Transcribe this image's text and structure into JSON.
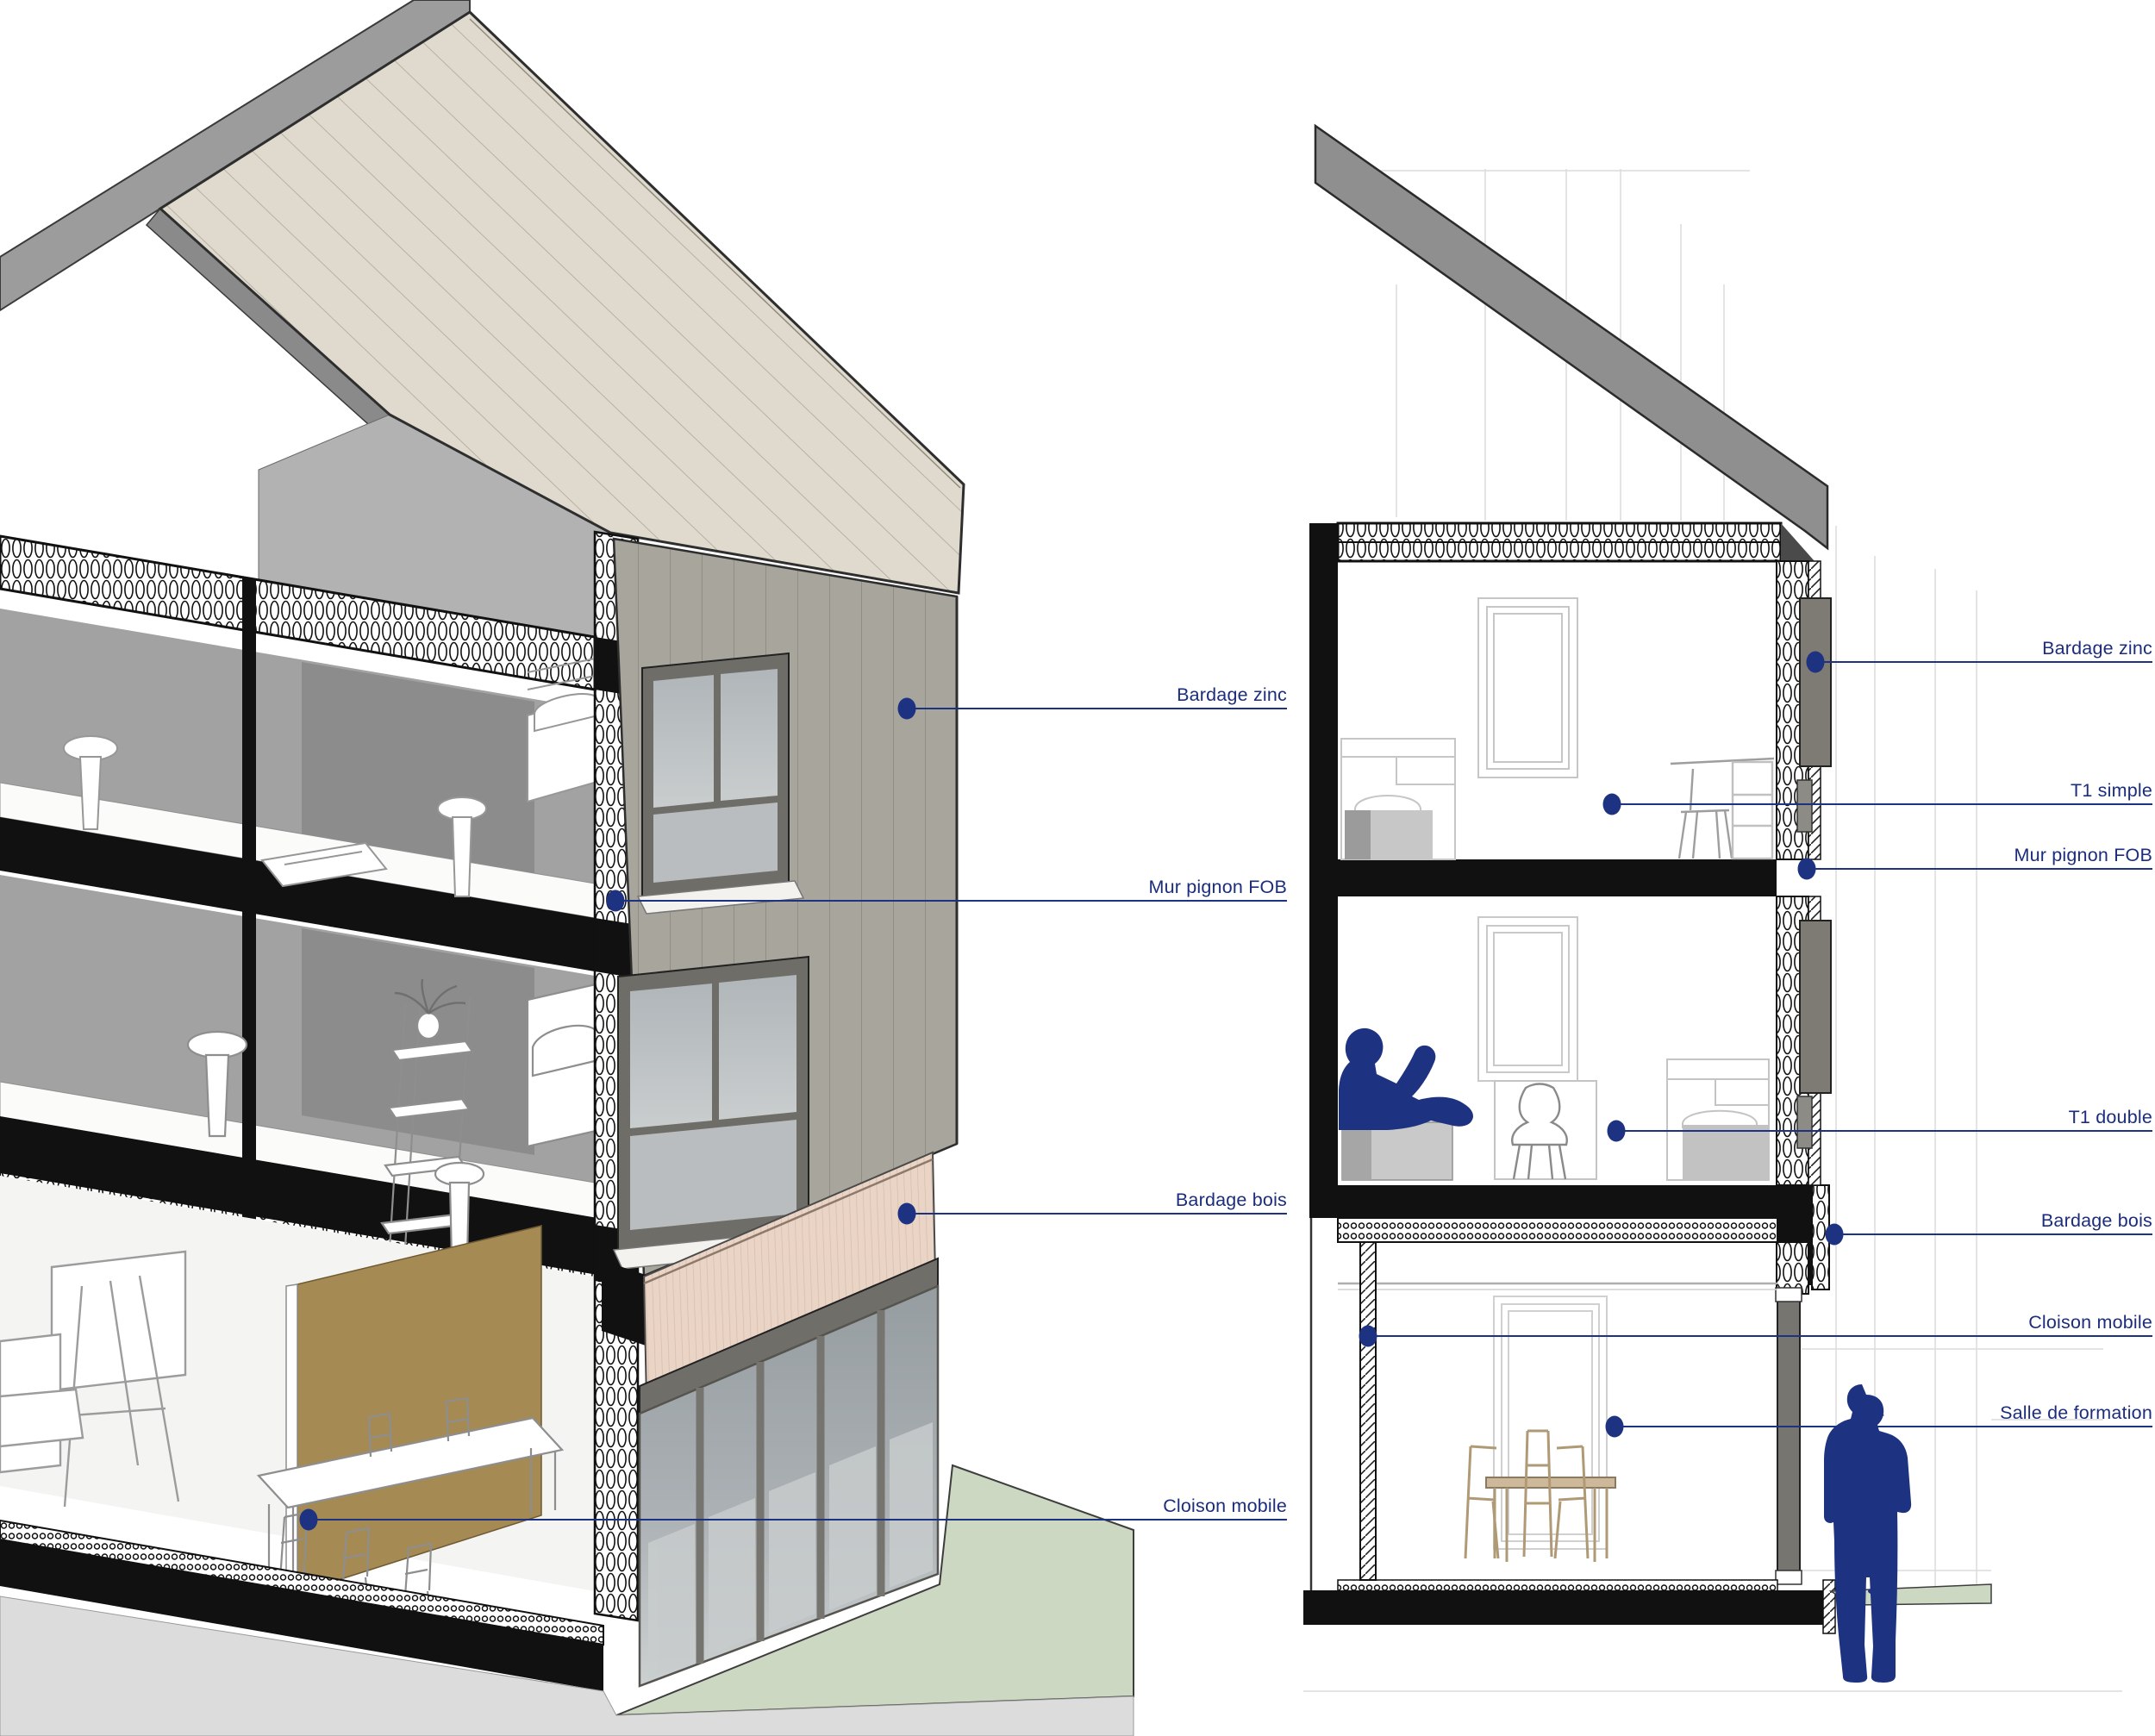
{
  "document": {
    "type": "architectural-section-drawings",
    "views": {
      "left": "3d-cutaway-axonometric",
      "right": "2d-cross-section"
    }
  },
  "colors": {
    "navy": "#1e3282",
    "label_text": "#1c2d7c",
    "roof_beige": "#dfdacd",
    "roof_gray": "#8f8f8f",
    "zinc_cladding": "#a8a59c",
    "wood_cladding": "#e9d4c6",
    "partition_brown": "#a58a54",
    "ground_green": "#ccd8c2",
    "slab_black": "#111111",
    "interior_gray": "#a2a2a2"
  },
  "figures": {
    "lounging_person": "person-silhouette-lounging",
    "standing_person": "person-silhouette-standing"
  },
  "annotations": {
    "left_view": {
      "label_x": 1493,
      "items": [
        {
          "label": "Bardage zinc",
          "dot": [
            1052,
            822
          ]
        },
        {
          "label": "Mur pignon FOB",
          "dot": [
            714,
            1045
          ]
        },
        {
          "label": "Bardage bois",
          "dot": [
            1052,
            1408
          ]
        },
        {
          "label": "Cloison mobile",
          "dot": [
            358,
            1763
          ]
        }
      ]
    },
    "right_view": {
      "label_x": 2497,
      "items": [
        {
          "label": "Bardage zinc",
          "dot": [
            2106,
            768
          ]
        },
        {
          "label": "T1 simple",
          "dot": [
            1870,
            933
          ]
        },
        {
          "label": "Mur pignon FOB",
          "dot": [
            2096,
            1008
          ]
        },
        {
          "label": "T1 double",
          "dot": [
            1875,
            1312
          ]
        },
        {
          "label": "Bardage bois",
          "dot": [
            2128,
            1432
          ]
        },
        {
          "label": "Cloison mobile",
          "dot": [
            1587,
            1550
          ]
        },
        {
          "label": "Salle de formation",
          "dot": [
            1873,
            1655
          ]
        }
      ]
    }
  }
}
